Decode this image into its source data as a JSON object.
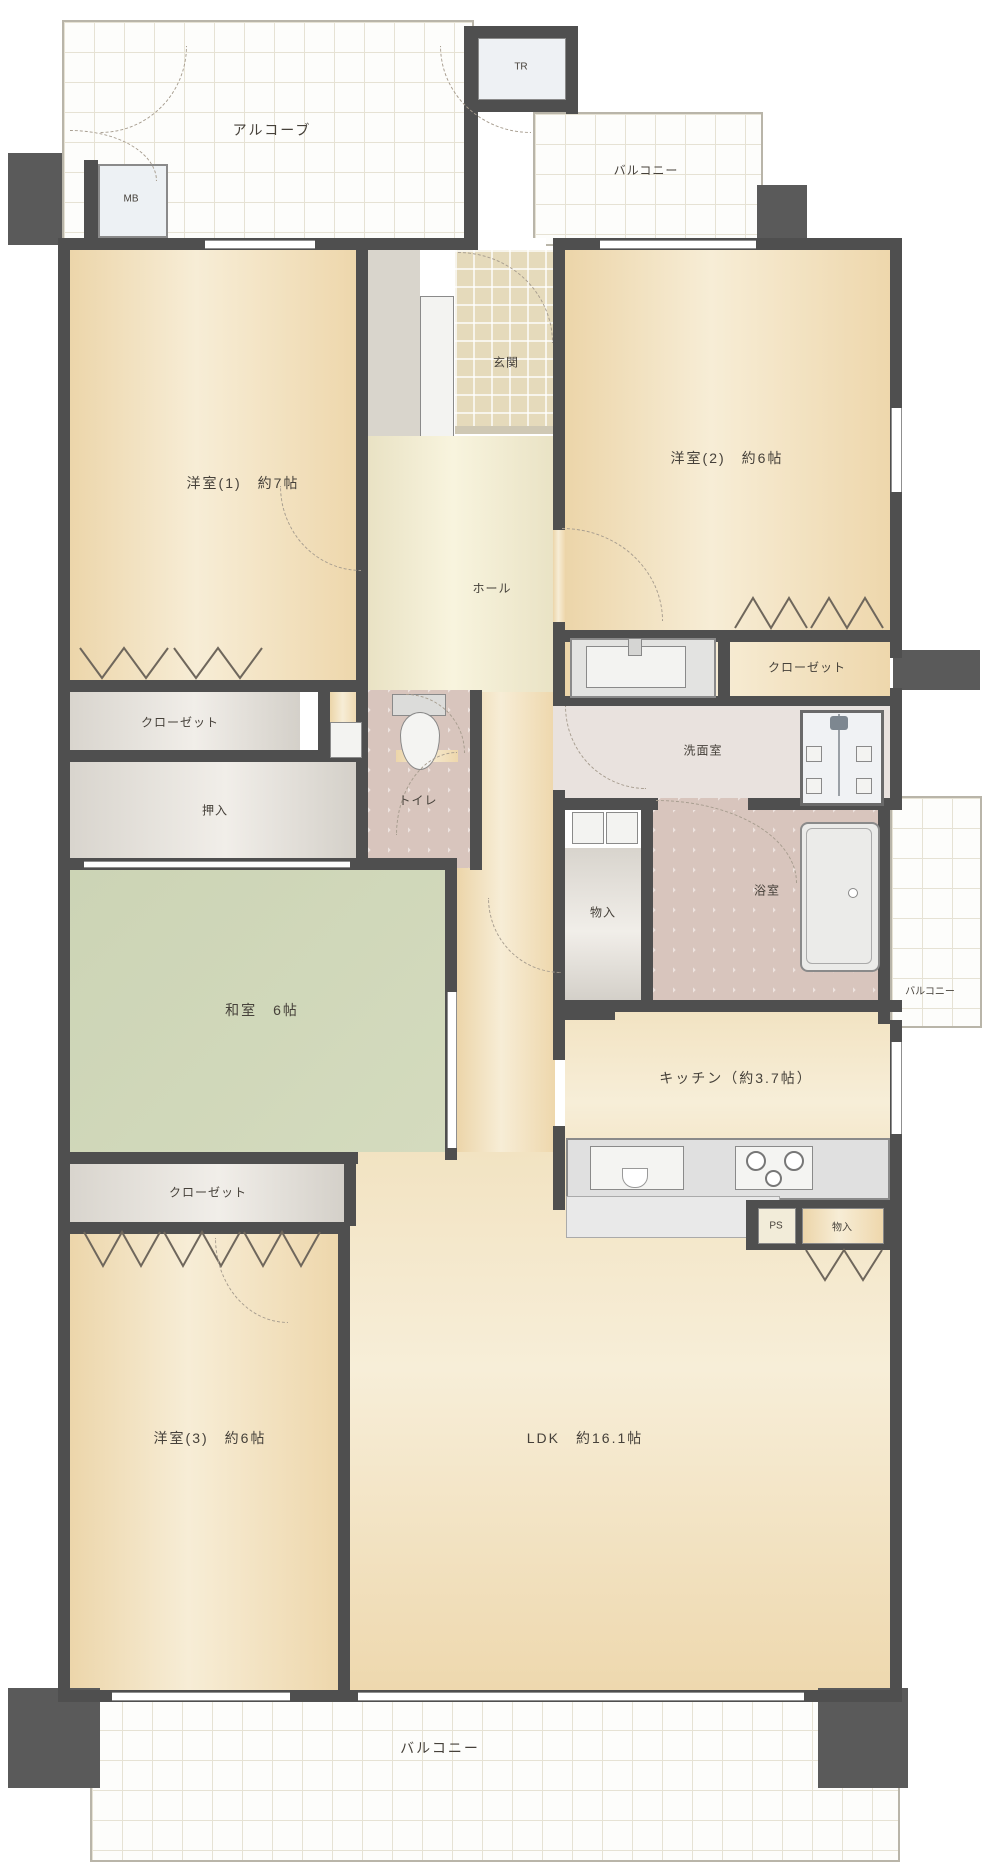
{
  "rooms": {
    "alcove": "アルコーブ",
    "mb": "MB",
    "tr": "TR",
    "balcony_top": "バルコニー",
    "balcony_right": "バルコニー",
    "balcony_bottom": "バルコニー",
    "genkan": "玄関",
    "hall": "ホール",
    "room1": "洋室(1)　約7帖",
    "room2": "洋室(2)　約6帖",
    "room3": "洋室(3)　約6帖",
    "washitsu": "和室　6帖",
    "ldk": "LDK　約16.1帖",
    "kitchen": "キッチン（約3.7帖）",
    "closet1": "クローゼット",
    "closet2": "クローゼット",
    "closet3": "クローゼット",
    "oshiire": "押入",
    "toilet": "トイレ",
    "washroom": "洗面室",
    "bathroom": "浴室",
    "storage1": "物入",
    "storage2": "物入",
    "pipe_space": "PS"
  },
  "colors": {
    "wall": "#4f4f4f",
    "room_beige": "#eed9b0",
    "tatami_green": "#cdd5b6",
    "closet_gray": "#e5e1da",
    "bath_pink": "#d8c5bd",
    "hall_cream": "#efe9cd",
    "balcony_white": "#fdfdfb"
  }
}
